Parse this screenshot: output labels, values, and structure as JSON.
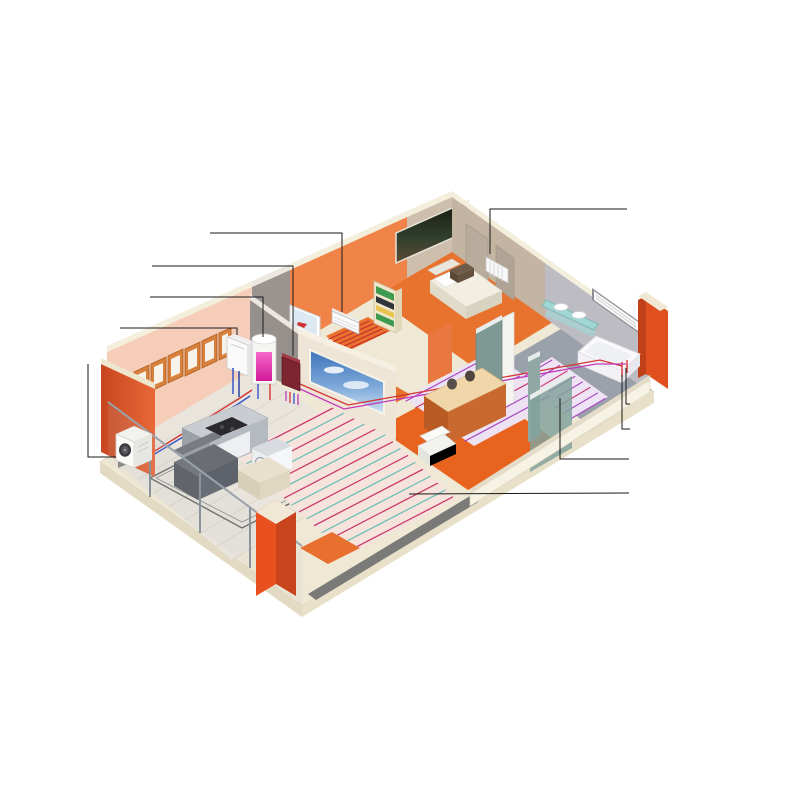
{
  "labels": {
    "left": [
      {
        "id": "fancoil",
        "lines": [
          "Фанкойл (працює влітку",
          "на охолодження, взимку на обігрів)"
        ]
      },
      {
        "id": "hydraulic-collector",
        "lines": [
          "Гідравлічний колектор"
        ]
      },
      {
        "id": "dhw-tank",
        "lines": [
          "Бак-накопичувач ГВП"
        ]
      },
      {
        "id": "indoor-unit",
        "lines": [
          "Внутрішній блок"
        ]
      },
      {
        "id": "outdoor-unit",
        "lines": [
          "Зовнішній блок"
        ]
      }
    ],
    "right": [
      {
        "id": "low-temp-radiator",
        "lines": [
          "Низькотемпературний радіатор",
          "(обігрів взимку)"
        ]
      },
      {
        "id": "from-water-supply",
        "lines": [
          "Від системного водопостачання"
        ]
      },
      {
        "id": "from-heat-pump",
        "lines": [
          "Від теплового насосу"
        ]
      },
      {
        "id": "warm-floor-bathroom",
        "lines": [
          "Тепла підлога"
        ]
      },
      {
        "id": "warm-floor-living",
        "lines": [
          "Тепла підлога"
        ]
      }
    ]
  },
  "colors": {
    "background": "#ffffff",
    "leader_line": "#1a1a1a",
    "label_text": "#111111",
    "brick_orange": "#e0501e",
    "exterior_wall": "#d9542a",
    "living_wall_orange": "#f08448",
    "kitchen_wall_salmon": "#f5cdb9",
    "bedroom_wall_tan": "#cdbfac",
    "teal_wall": "#7e9894",
    "slab_cream": "#efe8d4",
    "orange_floor": "#e8702c",
    "living_floor_pink": "#f6e3dc",
    "bath_tile_gray": "#9ba1ab",
    "heating_red": "#c83c6c",
    "heating_teal": "#6cc0b4",
    "heating_purple": "#a848c0",
    "tank_pink": "#e62fa5",
    "pipe_red": "#d43535",
    "pipe_blue": "#3555c8"
  }
}
